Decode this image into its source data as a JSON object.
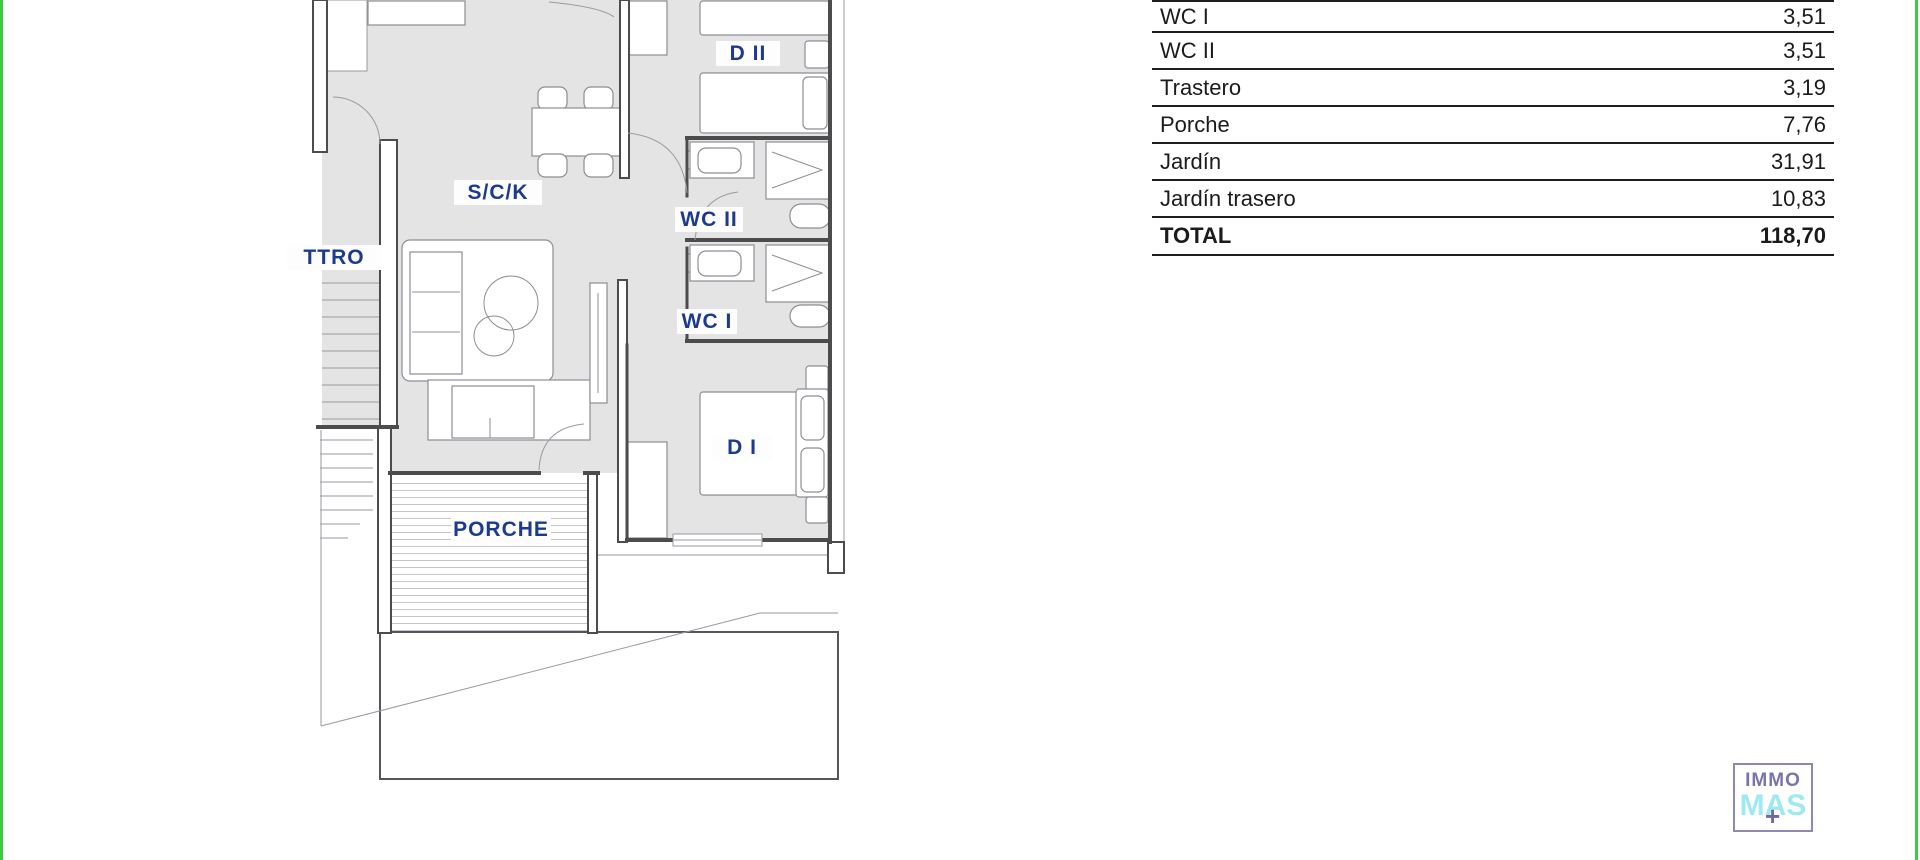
{
  "plan": {
    "rooms": [
      {
        "id": "d2",
        "label": "D II"
      },
      {
        "id": "sck",
        "label": "S/C/K"
      },
      {
        "id": "ttro",
        "label": "TTRO"
      },
      {
        "id": "wc2",
        "label": "WC II"
      },
      {
        "id": "wc1",
        "label": "WC I"
      },
      {
        "id": "d1",
        "label": "D I"
      },
      {
        "id": "porche",
        "label": "PORCHE"
      }
    ],
    "label_color": "#1c3a90",
    "room_fill": "#e4e4e4",
    "wall_color": "#4c4c4c"
  },
  "areas_table": {
    "rows": [
      {
        "label": "WC I",
        "value": "3,51"
      },
      {
        "label": "WC II",
        "value": "3,51"
      },
      {
        "label": "Trastero",
        "value": "3,19"
      },
      {
        "label": "Porche",
        "value": "7,76"
      },
      {
        "label": "Jardín",
        "value": "31,91"
      },
      {
        "label": "Jardín trasero",
        "value": "10,83"
      }
    ],
    "total": {
      "label": "TOTAL",
      "value": "118,70"
    }
  },
  "logo": {
    "line1": "IMMO",
    "line2": "MAS",
    "plus": "+"
  },
  "colors": {
    "edge_green": "#3fca43",
    "logo_purple": "#7a73ae",
    "logo_cyan": "#9fe9f2",
    "table_line": "#1f1f1f"
  }
}
